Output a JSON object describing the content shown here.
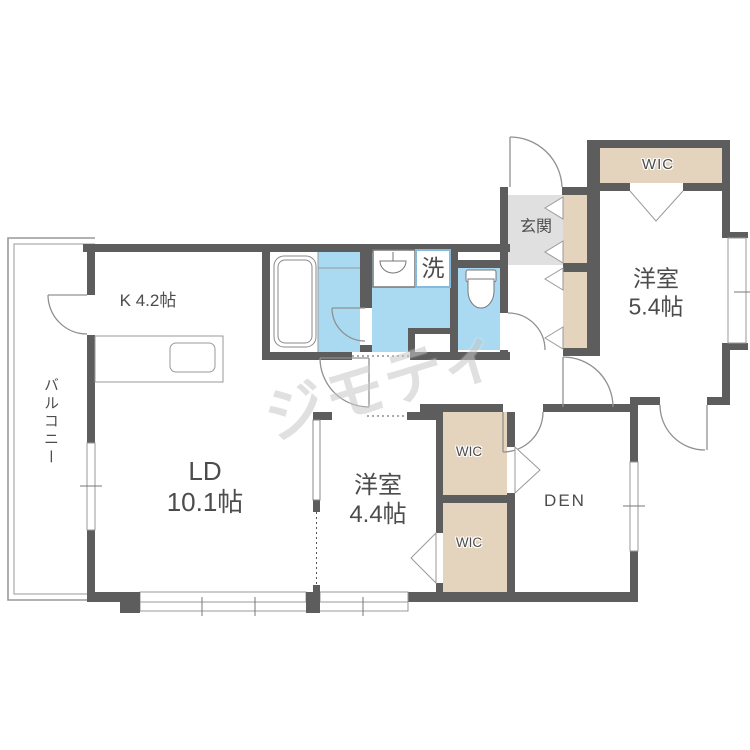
{
  "floorplan": {
    "labels": {
      "kitchen": "K 4.2帖",
      "living_dining_1": "LD",
      "living_dining_2": "10.1帖",
      "bedroom_small_1": "洋室",
      "bedroom_small_2": "4.4帖",
      "bedroom_large_1": "洋室",
      "bedroom_large_2": "5.4帖",
      "den": "DEN",
      "wic_main": "WIC",
      "wic_upper": "WIC",
      "wic_lower": "WIC",
      "entrance": "玄関",
      "balcony": "バルコニー",
      "laundry": "洗"
    },
    "colors": {
      "wall": "#5d5d5d",
      "wet_area": "#aadaf2",
      "closet": "#e4d4be",
      "entrance_floor": "#e0e0e0",
      "line": "#999999",
      "text": "#4c4c4c",
      "laundry_box_border": "#85badb"
    },
    "watermark": "ジモティ"
  }
}
